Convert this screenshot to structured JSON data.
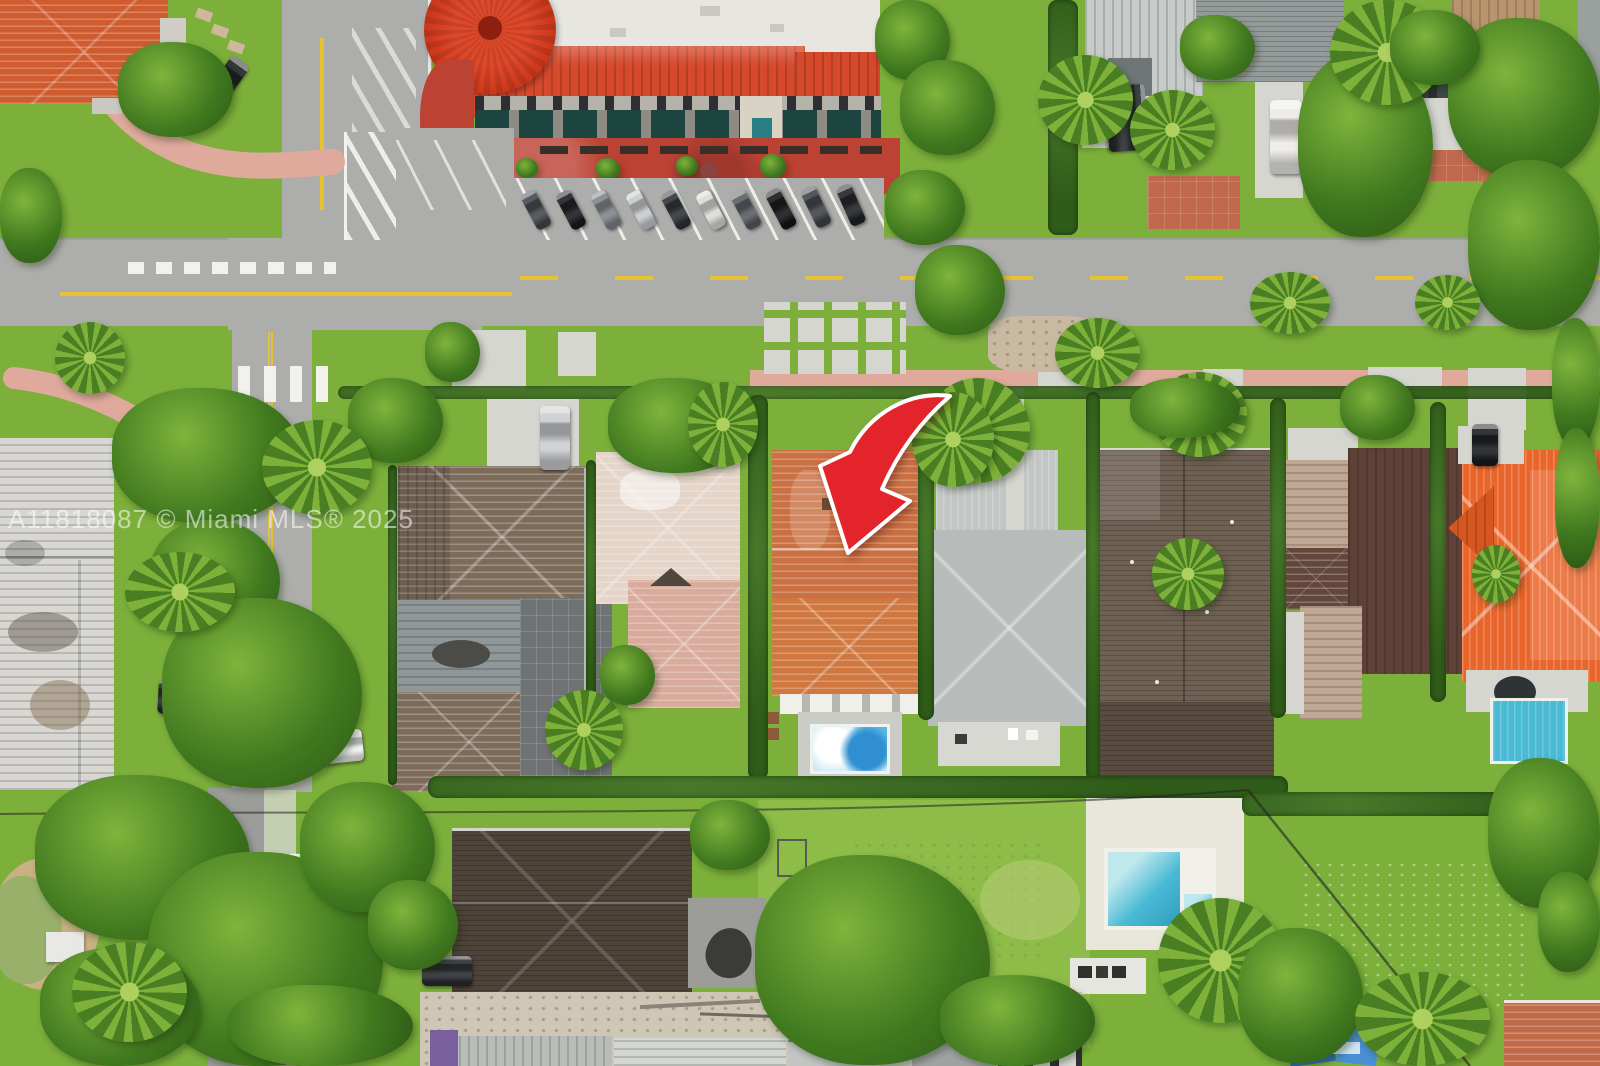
{
  "image": {
    "kind": "aerial-real-estate-photo",
    "width": 1600,
    "height": 1066,
    "alt": "Aerial drone view of a residential block; a red curved arrow marks the subject house with a terracotta tile roof and backyard pool"
  },
  "watermark": {
    "text": "A11818087 © Miami MLS® 2025"
  },
  "counts": {
    "diagonal-parked-cars-top-row": 10
  },
  "colors": {
    "lawn": "#7cb03b",
    "lawnLight": "#8dbc49",
    "lawnPale": "#b5cc74",
    "hedge": "#2f5c18",
    "treeDark": "#41791f",
    "treeLight": "#7fb43c",
    "road": "#adaeab",
    "roadDark": "#9c9d9a",
    "yellow": "#e5c332",
    "white": "#f2f2ec",
    "pink": "#dfa99c",
    "plaza": "#bc4234",
    "redTile": "#d6492b",
    "turret": "#c73418",
    "whiteRoof": "#e7e6e1",
    "facade": "#b5b2aa",
    "awning": "#1d453f",
    "concrete": "#d6d6d0",
    "brick": "#c0694f",
    "dirtTan": "#cfc7b6",
    "sand": "#c9b183",
    "pond": "#98b06a",
    "whiteBldg": "#d8d7d2",
    "brown": "#7e6c5b",
    "flatGray": "#8f9799",
    "patioGray": "#6f7374",
    "pinkWhite": "#e5d4c8",
    "pinkSmall": "#d8ab9c",
    "subject": "#ca7042",
    "subjectLower": "#d07840",
    "eave": "#b9b7b2",
    "poolDeck": "#ccccc6",
    "poolWater": "#3f9fd4",
    "poolLight": "#cfeaf5",
    "teal": "#49b9d4",
    "gray1": "#c2c6c4",
    "gray2": "#b7bcbb",
    "darkRoof": "#6e6052",
    "darkRoofLow": "#584c41",
    "maroon": "#5e4238",
    "tan": "#c0a794",
    "charcoal": "#4e4338",
    "annexGray": "#9c9c98",
    "orange": "#e8662c",
    "orangeDark": "#d5571f",
    "arrowRed": "#e3242b",
    "watermarkColor": "rgba(255,255,255,0.55)"
  }
}
